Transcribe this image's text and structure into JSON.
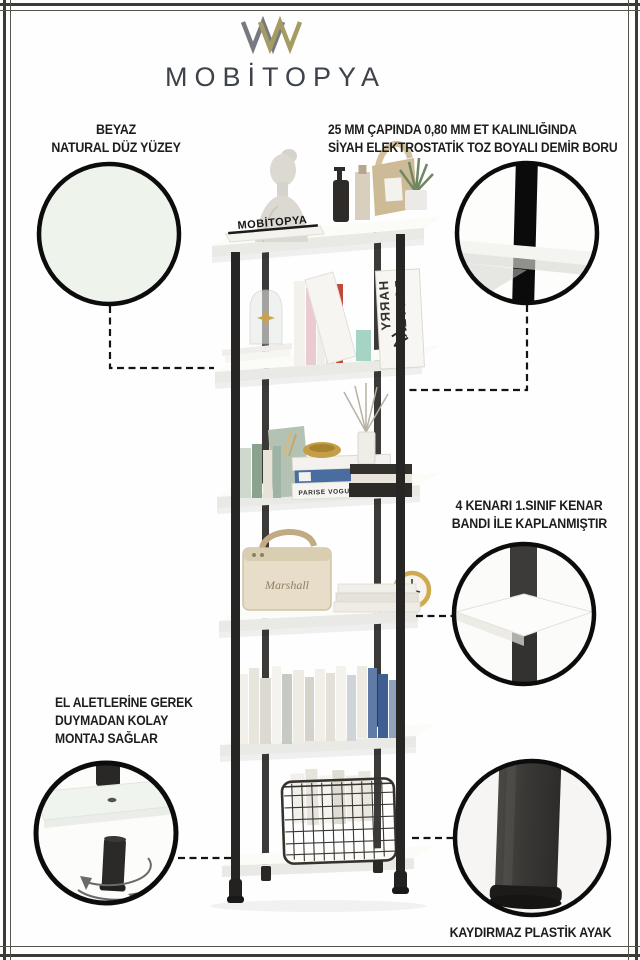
{
  "brand": {
    "name": "MOBİTOPYA"
  },
  "callouts": {
    "surface": {
      "line1": "BEYAZ",
      "line2": "NATURAL DÜZ YÜZEY"
    },
    "pipe": {
      "line1": "25 MM ÇAPINDA 0,80 MM ET KALINLIĞINDA",
      "line2": "SİYAH ELEKTROSTATİK TOZ BOYALI DEMİR BORU"
    },
    "edge_band": {
      "line1": "4 KENARI 1.SINIF KENAR",
      "line2": "BANDI İLE KAPLANMIŞTIR"
    },
    "assembly": {
      "line1": "EL ALETLERİNE GEREK",
      "line2": "DUYMADAN KOLAY",
      "line3": "MONTAJ SAĞLAR"
    },
    "foot": {
      "line1": "KAYDIRMAZ PLASTİK AYAK"
    }
  },
  "product": {
    "sign_text": "MOBİTOPYA",
    "book_word1": "HARRY",
    "book_word2": "POTTER",
    "box_label": "PARISE VOGUE",
    "speaker_brand": "Marshall"
  },
  "colors": {
    "accent_gold": "#A59C63",
    "logo_gray": "#767A80",
    "frame_line": "#3B3B34",
    "text_dark": "#1D1D1B",
    "swatch_surface": "#EEF3EC",
    "pipe_black": "#0B0B0B",
    "shelf_white": "#F7F7F4"
  }
}
